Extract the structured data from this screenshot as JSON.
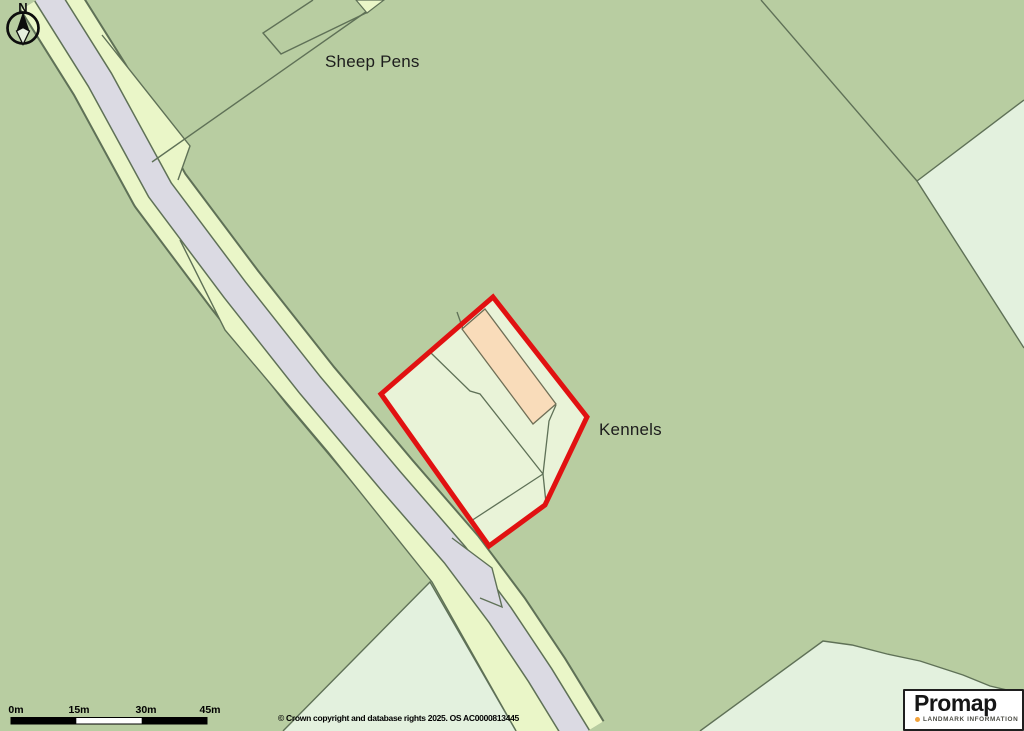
{
  "map": {
    "labels": {
      "sheep_pens": "Sheep Pens",
      "kennels": "Kennels"
    },
    "north_arrow": {
      "letter": "N",
      "icon": "compass-north-arrow-icon"
    },
    "scale_bar": {
      "ticks": [
        "0m",
        "15m",
        "30m",
        "45m"
      ]
    },
    "copyright_text": "© Crown copyright and database rights 2025. OS AC0000813445",
    "logo": {
      "brand": "Promap",
      "tagline": "LANDMARK INFORMATION",
      "dot_color": "#f2a33c"
    },
    "colors": {
      "field_green": "#b8cda1",
      "verge_pale_green": "#eaf6c8",
      "mint_field": "#e3f1de",
      "parcel_interior": "#e9f3d8",
      "road_gray": "#dbdae3",
      "boundary_line": "#5f7157",
      "site_boundary_red": "#e11111",
      "building_peach": "#f9dcba"
    }
  }
}
